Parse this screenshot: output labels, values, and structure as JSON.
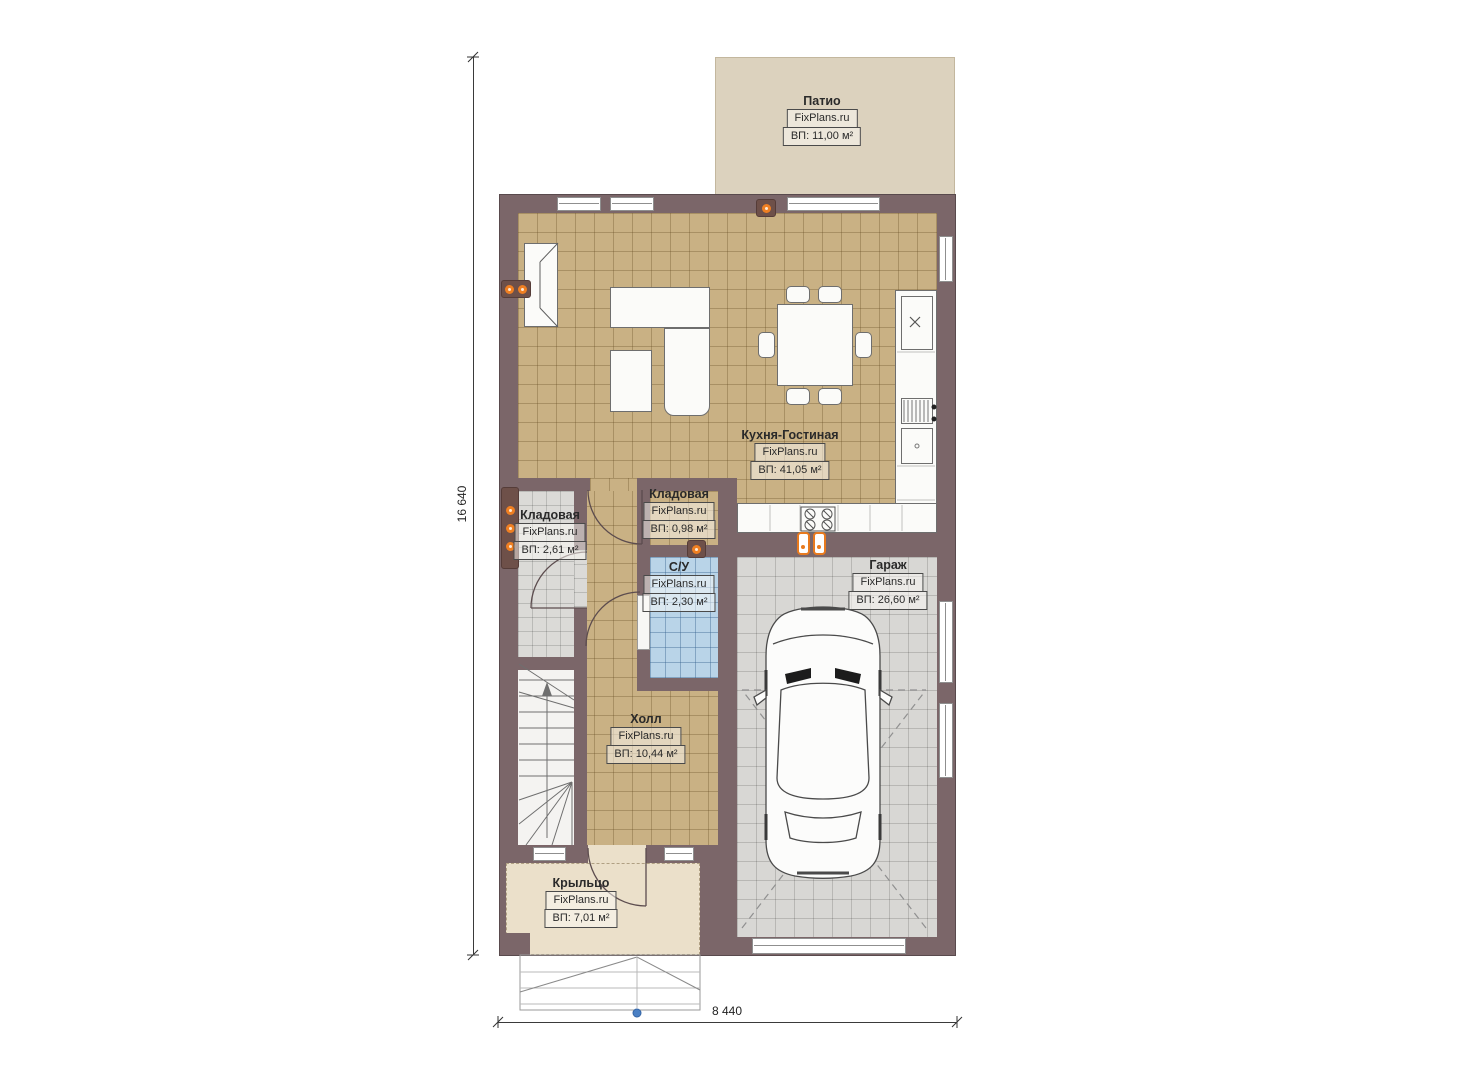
{
  "plan": {
    "brand_watermark": "FixPlans.ru",
    "dimensions": {
      "left": "16 640",
      "bottom": "8 440"
    },
    "rooms": [
      {
        "key": "patio",
        "name": "Патио",
        "brand": "FixPlans.ru",
        "area": "ВП: 11,00 м²"
      },
      {
        "key": "kitchen-living",
        "name": "Кухня-Гостиная",
        "brand": "FixPlans.ru",
        "area": "ВП: 41,05 м²"
      },
      {
        "key": "pantry",
        "name": "Кладовая",
        "brand": "FixPlans.ru",
        "area": "ВП: 2,61 м²"
      },
      {
        "key": "pantry-small",
        "name": "Кладовая",
        "brand": "FixPlans.ru",
        "area": "ВП: 0,98 м²"
      },
      {
        "key": "bathroom",
        "name": "С/У",
        "brand": "FixPlans.ru",
        "area": "ВП: 2,30 м²"
      },
      {
        "key": "hall",
        "name": "Холл",
        "brand": "FixPlans.ru",
        "area": "ВП: 10,44 м²"
      },
      {
        "key": "garage",
        "name": "Гараж",
        "brand": "FixPlans.ru",
        "area": "ВП: 26,60 м²"
      },
      {
        "key": "porch",
        "name": "Крыльцо",
        "brand": "FixPlans.ru",
        "area": "ВП: 7,01 м²"
      }
    ],
    "colors": {
      "wall": "#7b6669",
      "room_tile": "#c9b184",
      "garage_tile": "#d8d7d4",
      "bath_tile": "#b9d4e8",
      "patio": "#dcd2be",
      "porch": "#ebe0ca",
      "marker_orange": "#ef7f22",
      "node_blue": "#4a80c4"
    },
    "symbols": [
      "socket-marker",
      "floor-outlet",
      "car-top-view",
      "staircase",
      "door-swing",
      "window",
      "cooktop",
      "sink",
      "fireplace"
    ]
  }
}
